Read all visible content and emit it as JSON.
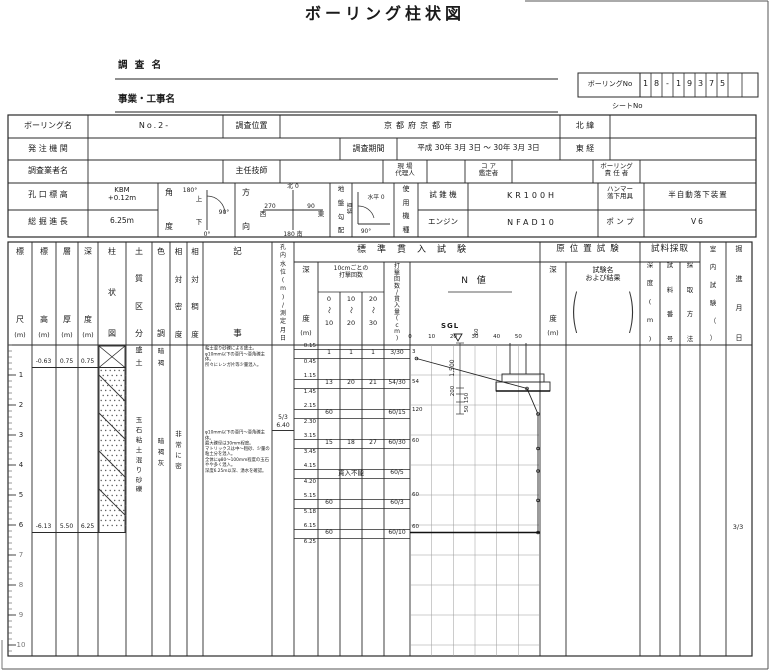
{
  "title": "ボーリング柱状図",
  "boring_no": {
    "label": "ボーリングNo",
    "cells": [
      "1",
      "8",
      "-",
      "1",
      "9",
      "3",
      "7",
      "5",
      "",
      ""
    ]
  },
  "survey": {
    "name_label": "調  査  名",
    "project_label": "事業・工事名",
    "sheet_label": "シートNo"
  },
  "info": {
    "boring_name_label": "ボーリング名",
    "boring_name": "No.2-",
    "location_label": "調査位置",
    "location": "京都府京都市",
    "north_label": "北    緯",
    "north": "",
    "client_label": "発 注 機 関",
    "client": "",
    "period_label": "調査期間",
    "period": "平成 30年 3月 3日 〜 30年 3月 3日",
    "east_label": "東    経",
    "east": "",
    "agency_label": "調査業者名",
    "agency": "",
    "engineer_label": "主任技師",
    "engineer": "",
    "agent_label": "現  場\n代理人",
    "agent": "",
    "core_label": "コ  ア\n鑑定者",
    "core": "",
    "resp_label": "ボーリング\n責 任 者",
    "resp": ""
  },
  "rig": {
    "elev_label": "孔 口 標 高",
    "elev": "KBM\n+0.12m",
    "length_label": "総 掘 進 長",
    "length": "6.25m",
    "angle_label": "角度",
    "angle_marks": {
      "top": "180°",
      "up": "上",
      "right": "90°",
      "down": "下",
      "bottom": "0°"
    },
    "dir_label": "方向",
    "compass": {
      "n": "北 0",
      "e_val": "90",
      "e": "東",
      "s_val": "180",
      "s": "南",
      "w_val": "270",
      "w": "西"
    },
    "slope_label": "地盤勾配",
    "slope_marks": {
      "h": "水平 0",
      "v": "鉛直",
      "v_deg": "90°"
    },
    "machine_label": "使用機種",
    "drill_label": "試 錐 機",
    "drill": "KR100H",
    "hammer_label": "ハンマー\n落下用具",
    "hammer": "半自動落下装置",
    "engine_label": "エンジン",
    "engine": "NFAD10",
    "pump_label": "ポ ン プ",
    "pump": "V6"
  },
  "columns": {
    "scale": "標尺",
    "scale_u": "(m)",
    "elev": "標高",
    "elev_u": "(m)",
    "thick": "層厚",
    "thick_u": "(m)",
    "depth": "深度",
    "depth_u": "(m)",
    "strata": "柱状図",
    "soil": "土質区分",
    "color": "色調",
    "density": "相対密度",
    "consistency": "相対稠度",
    "remarks": "記事",
    "water": "孔内水位(m)/測定月日",
    "spt_group": "標準貫入試験",
    "spt_depth": "深度",
    "spt_depth_u": "(m)",
    "blows10": "10cmごとの\n打撃回数",
    "ranges": [
      [
        "0",
        "10"
      ],
      [
        "10",
        "20"
      ],
      [
        "20",
        "30"
      ]
    ],
    "fraction": "打撃回数/貫入量(cm)",
    "n_value": "N  値",
    "axis_ticks": [
      "0",
      "10",
      "20",
      "30",
      "40",
      "50"
    ],
    "insitu_group": "原位置試験",
    "insitu_depth": "深度",
    "insitu_depth_u": "(m)",
    "insitu_name": "試験名\nおよび結果",
    "sample_group": "試料採取",
    "sample_depth": "深度(m)",
    "sample_no": "試料番号",
    "sample_method": "採取方法",
    "lab": "室内試験（　）",
    "drill_date_col": "掘進月日"
  },
  "scale_numbers": [
    "1",
    "2",
    "3",
    "4",
    "5",
    "6",
    "7",
    "8",
    "9",
    "10"
  ],
  "layers": [
    {
      "elevation": "-0.63",
      "thickness": "0.75",
      "depth": "0.75",
      "top_m": 0,
      "bottom_m": 0.75,
      "soil": "盛土",
      "color": "暗褐",
      "density": "",
      "pattern": "crossbox",
      "remarks": "粘土混り砂礫による盛土。\nφ10mm以下の亜円〜亜角礫主体。\n所々にレンガ片等少量混入。"
    },
    {
      "elevation": "-6.13",
      "thickness": "5.50",
      "depth": "6.25",
      "top_m": 0.75,
      "bottom_m": 6.25,
      "soil": "玉石粘土混り砂礫",
      "color": "暗褐灰",
      "density": "非常に密",
      "pattern": "gravel",
      "remarks": "φ10mm以下の亜円〜亜角礫主体。\n最大礫径は30mm程度。\nマトリックスは中〜粗砂、少量の\n粘土分を混入。\n全体にφ80〜100mm程度の玉石\nやや多く混入。\n深度6.25m以深、湧水を確認。"
    }
  ],
  "spt": {
    "tests": [
      {
        "top": "0.15",
        "bottom": "0.45",
        "blows": [
          "1",
          "1",
          "1"
        ],
        "result": "3/30",
        "note": ""
      },
      {
        "top": "1.15",
        "bottom": "1.45",
        "blows": [
          "13",
          "20",
          "21"
        ],
        "result": "54/30",
        "note": ""
      },
      {
        "top": "2.15",
        "bottom": "2.30",
        "blows": [
          "60",
          "",
          ""
        ],
        "result": "60/15",
        "note": ""
      },
      {
        "top": "3.15",
        "bottom": "3.45",
        "blows": [
          "15",
          "18",
          "27"
        ],
        "result": "60/30",
        "note": ""
      },
      {
        "top": "4.15",
        "bottom": "4.20",
        "blows": [],
        "result": "60/5",
        "note": "貫入不能"
      },
      {
        "top": "5.15",
        "bottom": "5.18",
        "blows": [
          "60",
          "",
          ""
        ],
        "result": "60/3",
        "note": ""
      },
      {
        "top": "6.15",
        "bottom": "6.25",
        "blows": [
          "60",
          "",
          ""
        ],
        "result": "60/10",
        "note": ""
      }
    ]
  },
  "graph": {
    "n_labels": [
      {
        "text": "3",
        "depth": 0.32
      },
      {
        "text": "54",
        "depth": 1.32
      },
      {
        "text": "120",
        "depth": 2.25
      },
      {
        "text": "60",
        "depth": 3.3
      },
      {
        "text": "60",
        "depth": 5.1
      },
      {
        "text": "60",
        "depth": 6.18
      }
    ]
  },
  "water": {
    "date": "5/3",
    "level": "6.40"
  },
  "drill_date": "3/3",
  "sketch": {
    "sgl": "SGL",
    "note": "60",
    "dims": [
      "1,500",
      "200",
      "150",
      "50"
    ]
  },
  "chart_data": {
    "type": "line",
    "title": "標準貫入試験 N値",
    "xlabel": "N値",
    "ylabel": "深度(m)",
    "xlim": [
      0,
      60
    ],
    "ylim": [
      0,
      10.4
    ],
    "legend": false,
    "grid": true,
    "series": [
      {
        "name": "N値",
        "x": [
          3,
          54,
          120,
          60,
          60,
          60,
          60
        ],
        "y": [
          0.45,
          1.45,
          2.3,
          3.45,
          4.2,
          5.18,
          6.25
        ],
        "note": "N>60は右端にクリップして描画、深度4.20mは貫入不能"
      }
    ]
  }
}
